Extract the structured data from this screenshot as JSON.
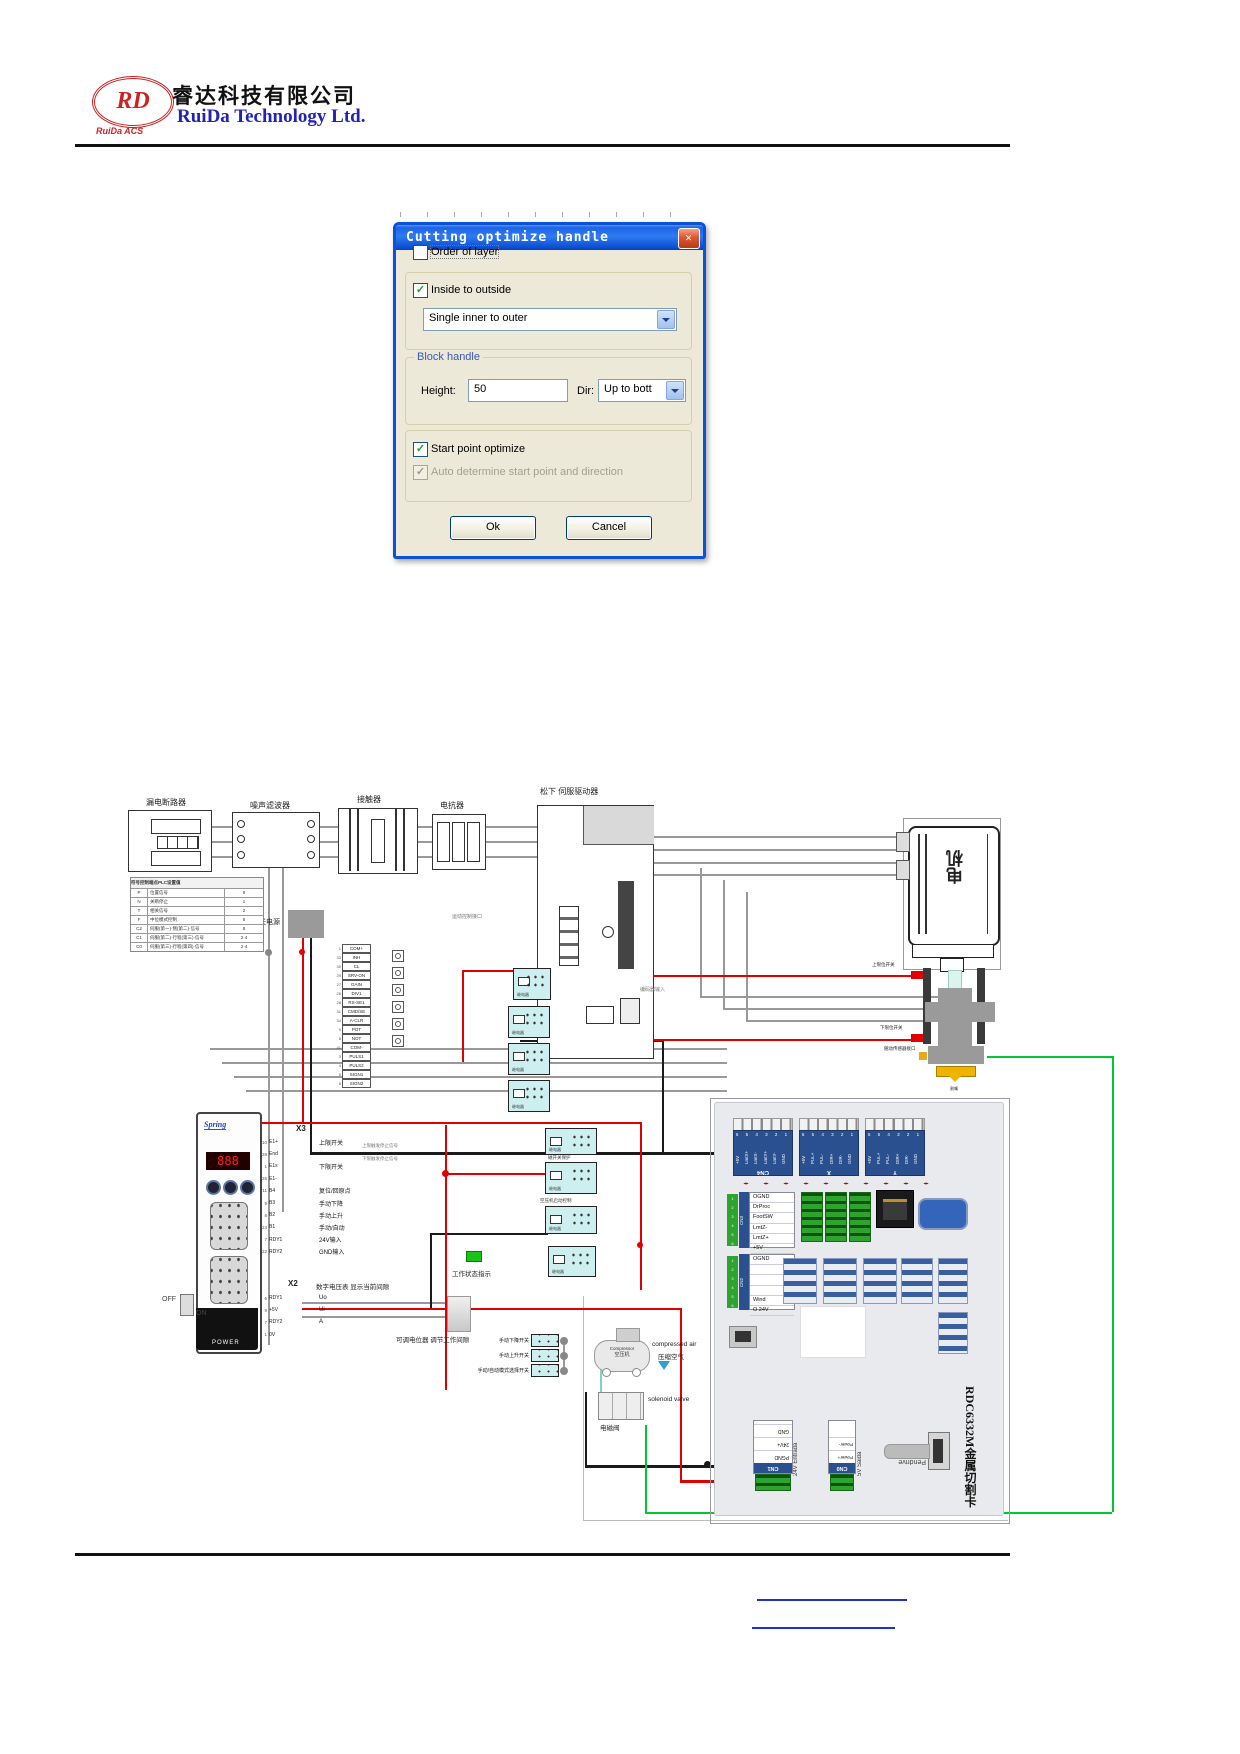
{
  "header": {
    "logo_rd": "RD",
    "logo_sub": "RuiDa ACS",
    "company_cn": "睿达科技有限公司",
    "company_en": "RuiDa Technology Ltd."
  },
  "dialog": {
    "title": "Cutting optimize handle",
    "close_glyph": "✕",
    "order_of_layer": "Order of layer",
    "inside_to_outside": "Inside to outside",
    "inner_combo": "Single inner to outer",
    "block_handle": "Block handle",
    "height_label": "Height:",
    "height_value": "50",
    "dir_label": "Dir:",
    "dir_value": "Up to bott",
    "start_point": "Start point optimize",
    "auto_determine": "Auto determine start point and direction",
    "ok": "Ok",
    "cancel": "Cancel"
  },
  "diagram": {
    "labels": {
      "breaker": "漏电断路器",
      "filter": "噪声滤波器",
      "contactor": "接触器",
      "reactor": "电抗器",
      "servo": "松下  伺服驱动器",
      "motor": "电机",
      "dc": "直流开关电源",
      "enc": "编码器输入",
      "motion": "运动控制接口",
      "upper": "上限位开关",
      "lower": "下限位开关",
      "follow": "随动传感器接口",
      "nozzle": "割嘴",
      "x3": "X3",
      "x1": "X1",
      "x2": "X2",
      "volt_note": "数字电压表 显示当前间隙",
      "pot_note": "可调电位器 调节工作间隙",
      "work": "工作状态指示",
      "note1": "上限触发停止信号",
      "note2": "下限触发停止信号",
      "relay": "继电器",
      "relay_t1": "磁开关保护",
      "relay_t2": "空压机启动控制",
      "comp_en": "Compressor",
      "comp_cn": "空压机",
      "air_en": "compressed air",
      "air_cn": "压缩空气",
      "sol_en": "solenoid valve",
      "sol_cn": "电磁阀",
      "spring": "Spring",
      "power": "POWER",
      "off": "OFF",
      "on": "ON",
      "pendrive": "Pendrive",
      "entrada": "24V Entrada",
      "saida": "5V Saida",
      "card": "RDC6332M金属切割卡"
    },
    "table": {
      "headers": [
        "符号",
        "控制端点",
        "PLC设置值"
      ],
      "rows": [
        [
          "P",
          "位置信号",
          "6"
        ],
        [
          "N",
          "关断停止",
          "1"
        ],
        [
          "T",
          "相关信号",
          "2"
        ],
        [
          "F",
          "中位模式控制",
          "6"
        ],
        [
          "C2",
          "伺服(第一)·侧(第二)·信号",
          "8"
        ],
        [
          "C1",
          "伺服(第二)·行程(第三)·信号",
          "2·4"
        ],
        [
          "C0",
          "伺服(第三)·行程(第四)·信号",
          "2·4"
        ]
      ]
    },
    "servo_pins": [
      {
        "n": "1",
        "name": "COM+"
      },
      {
        "n": "33",
        "name": "INH"
      },
      {
        "n": "30",
        "name": "CL"
      },
      {
        "n": "29",
        "name": "SRV-ON"
      },
      {
        "n": "27",
        "name": "GAIN"
      },
      {
        "n": "26",
        "name": "DIV1"
      },
      {
        "n": "28",
        "name": "RS-SE1"
      },
      {
        "n": "31",
        "name": "CMD/SE"
      },
      {
        "n": "34",
        "name": "A-CLR"
      },
      {
        "n": "9",
        "name": "POT"
      },
      {
        "n": "8",
        "name": "NOT"
      },
      {
        "n": "41",
        "name": "COM-"
      },
      {
        "n": "3",
        "name": "PULS1"
      },
      {
        "n": "4",
        "name": "PULS2"
      },
      {
        "n": "5",
        "name": "SIGN1"
      },
      {
        "n": "6",
        "name": "SIGN2"
      }
    ],
    "x3_pins": [
      {
        "n": "10",
        "name": "E1+",
        "label": "上限开关"
      },
      {
        "n": "28",
        "name": "End",
        "label": ""
      },
      {
        "n": "1",
        "name": "E1s",
        "label": "下限开关"
      },
      {
        "n": "25",
        "name": "E1-",
        "label": ""
      },
      {
        "n": "11",
        "name": "B4",
        "label": "复位/回原点"
      },
      {
        "n": "9",
        "name": "B3",
        "label": "手动下降"
      },
      {
        "n": "8",
        "name": "B2",
        "label": "手动上升"
      },
      {
        "n": "24",
        "name": "B1",
        "label": "手动/自动"
      },
      {
        "n": "7",
        "name": "RDY1",
        "label": "24V输入"
      },
      {
        "n": "22",
        "name": "RDY2",
        "label": "GND输入"
      }
    ],
    "x2_pins": [
      {
        "n": "6",
        "name": "RDY1",
        "label": "Uo"
      },
      {
        "n": "9",
        "name": "+5V",
        "label": "Ui"
      },
      {
        "n": "7",
        "name": "RDY2",
        "label": "A"
      },
      {
        "n": "1",
        "name": "0V",
        "label": ""
      }
    ],
    "switches": [
      "手动下降开关",
      "手动上升开关",
      "手动/自动模式选择开关"
    ],
    "board": {
      "cn4": {
        "name": "CN4",
        "nums": "6 5 4 3 2 1",
        "pins": [
          "+5V",
          "LmtX+",
          "LmtX-",
          "LmtY+",
          "LmtY-",
          "GND"
        ]
      },
      "ax_x": {
        "name": "X",
        "nums": "6 5 4 3 2 1",
        "pins": [
          "+5V",
          "PUL+",
          "PUL-",
          "DIR+",
          "DIR-",
          "GND"
        ]
      },
      "ax_y": {
        "name": "Y",
        "nums": "6 5 4 3 2 1",
        "pins": [
          "+5V",
          "PUL+",
          "PUL-",
          "DIR+",
          "DIR-",
          "GND"
        ]
      },
      "cn3": {
        "name": "CN3",
        "rows": [
          "OGND",
          "DrProc",
          "FootSW",
          "LmtZ-",
          "LmtZ+",
          "+5V"
        ]
      },
      "cn2": {
        "name": "CN2",
        "rows": [
          "OGND",
          "",
          "",
          "",
          "Wind",
          "O 24V"
        ]
      },
      "cn1": {
        "name": "CN1",
        "rows": [
          "PGND",
          "24V+",
          "GND"
        ]
      },
      "cn0": {
        "name": "CN0",
        "rows": [
          "Power+",
          "Power-"
        ]
      }
    }
  }
}
